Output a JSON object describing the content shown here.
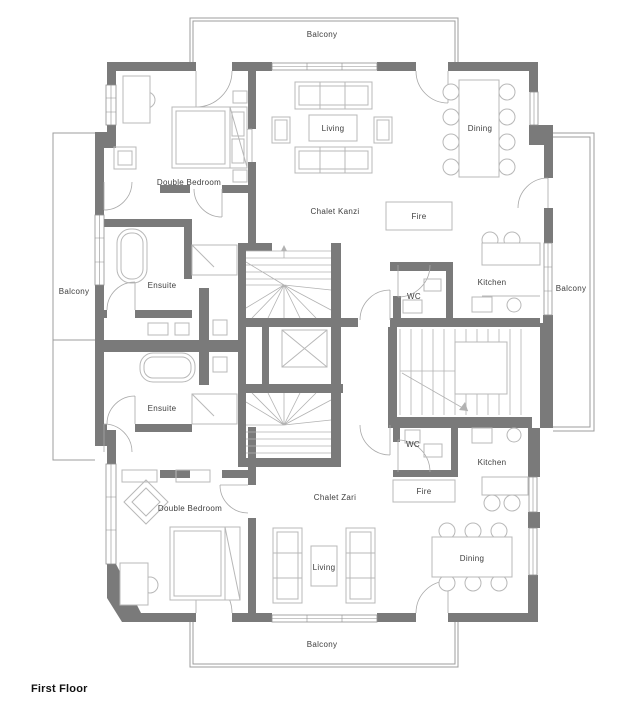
{
  "title": "First Floor",
  "colors": {
    "wall": "#7a7a7a",
    "lines": "#9c9c9c",
    "furniture": "#b8b8b8",
    "text": "#3d3d3d"
  },
  "chalets": {
    "top": "Chalet Kanzi",
    "bottom": "Chalet Zari"
  },
  "labels": {
    "balcony_top": "Balcony",
    "balcony_left": "Balcony",
    "balcony_right": "Balcony",
    "balcony_bottom": "Balcony",
    "bedroom_top": "Double Bedroom",
    "bedroom_bottom": "Double Bedroom",
    "ensuite_top": "Ensuite",
    "ensuite_bottom": "Ensuite",
    "living_top": "Living",
    "living_bottom": "Living",
    "dining_top": "Dining",
    "dining_bottom": "Dining",
    "kitchen_top": "Kitchen",
    "kitchen_bottom": "Kitchen",
    "wc_top": "WC",
    "wc_bottom": "WC",
    "fire_top": "Fire",
    "fire_bottom": "Fire",
    "floor_title": "First Floor"
  }
}
